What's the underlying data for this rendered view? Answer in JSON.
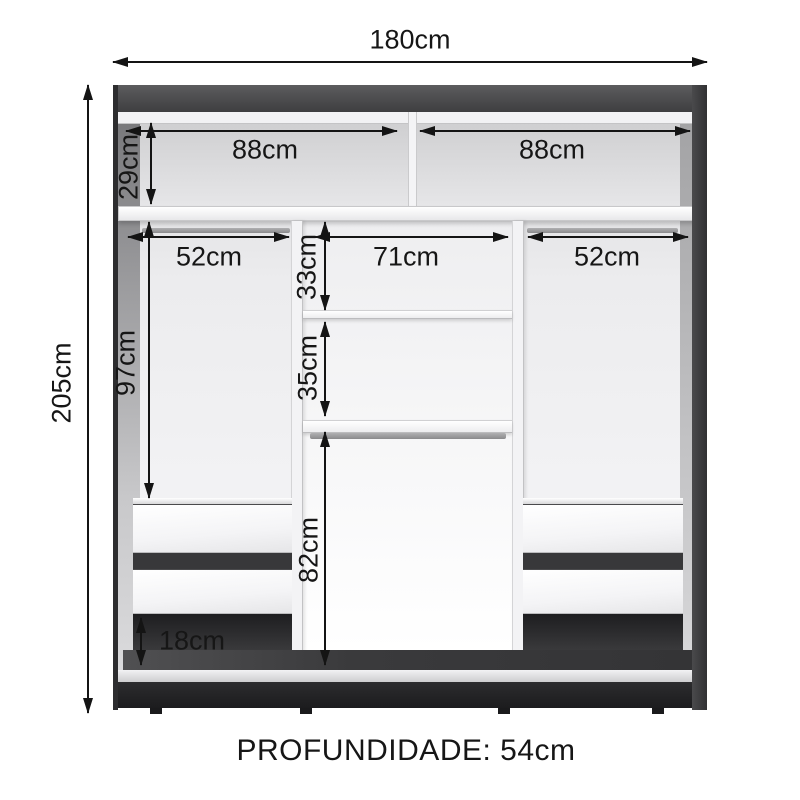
{
  "diagram": {
    "type": "wardrobe-internal-dimensions",
    "depth_label": "PROFUNDIDADE: 54cm",
    "dims": {
      "total_width": "180cm",
      "total_height": "205cm",
      "top_left_width": "88cm",
      "top_right_width": "88cm",
      "top_compartment_height": "29cm",
      "left_column_width": "52cm",
      "center_column_width": "71cm",
      "right_column_width": "52cm",
      "center_upper_gap": "33cm",
      "center_lower_gap": "35cm",
      "left_column_height": "97cm",
      "hanging_space_height": "82cm",
      "base_gap_height": "18cm"
    },
    "colors": {
      "frame_dark": "#3a3a3c",
      "plinth": "#232325",
      "interior_light": "#ececee",
      "shelf_white": "#fbfbfd",
      "dimension_text": "#161616"
    }
  }
}
